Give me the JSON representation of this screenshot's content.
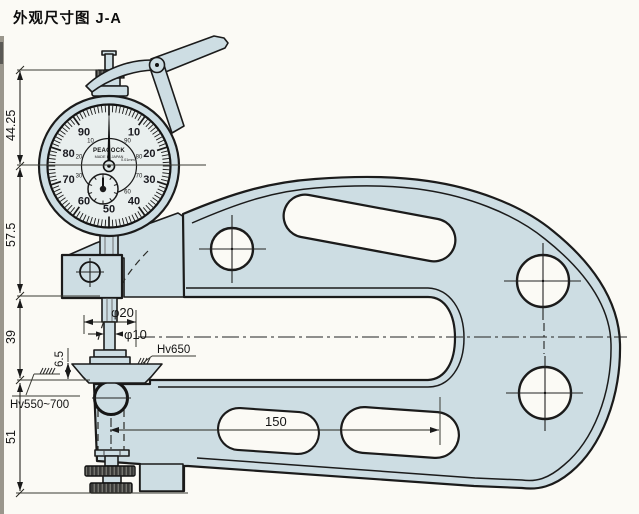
{
  "title": "外观尺寸图 J-A",
  "colors": {
    "background": "#fbfaf5",
    "body_fill": "#cddde3",
    "face_fill": "#e9efee",
    "outline": "#1b1b1b",
    "knurl_dark": "#3a3a38",
    "strip": "#9a968c"
  },
  "dial": {
    "brand": "PEACOCK",
    "origin": "MADE IN JAPAN",
    "graduation": "0.01mm",
    "outer_numbers": [
      "10",
      "20",
      "30",
      "40",
      "50",
      "60",
      "70",
      "80",
      "90"
    ],
    "inner_numbers": [
      "90",
      "80",
      "70",
      "60",
      "50",
      "40",
      "30",
      "20",
      "10"
    ]
  },
  "dimensions": {
    "overall_top": "44.25",
    "upper_section": "57.5",
    "mid_section": "39",
    "anvil_height": "6.5",
    "lower_section": "51",
    "throat_depth": "150",
    "contact_dia": "φ20",
    "spindle_dia": "φ10",
    "hardness_upper": "Hv650",
    "hardness_lower": "Hv550~700"
  }
}
